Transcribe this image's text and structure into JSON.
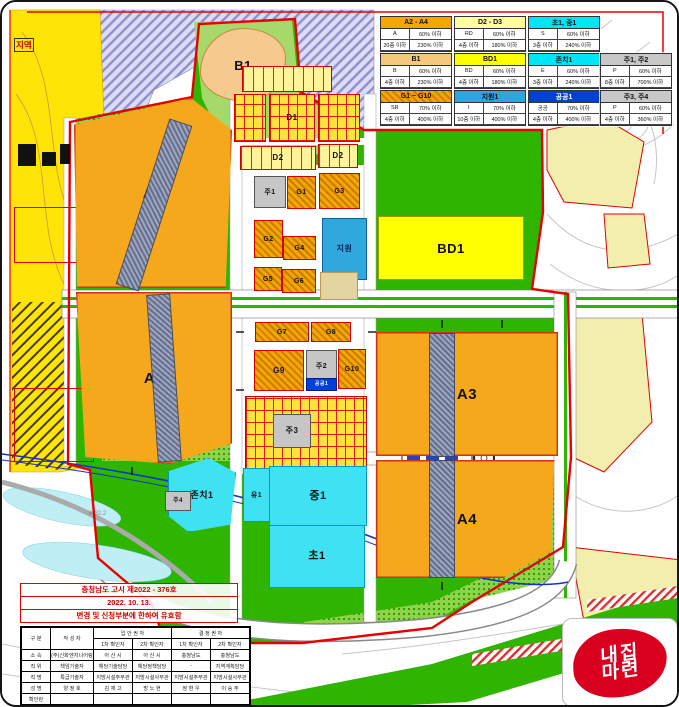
{
  "legend": {
    "items": [
      {
        "title": "A2 - A4",
        "color": "#F7A600",
        "hatched": false,
        "text_color": "#111",
        "cells": [
          [
            "A",
            "60% 이하"
          ],
          [
            "20층 이하",
            "230% 이하"
          ]
        ]
      },
      {
        "title": "D2 - D3",
        "color": "#FFFF9E",
        "hatched": false,
        "text_color": "#111",
        "cells": [
          [
            "RD",
            "60% 이하"
          ],
          [
            "4층 이하",
            "180% 이하"
          ]
        ]
      },
      {
        "title": "초1, 중1",
        "color": "#00E6F6",
        "hatched": false,
        "text_color": "#111",
        "cells": [
          [
            "S",
            "60% 이하"
          ],
          [
            "3층 이하",
            "240% 이하"
          ]
        ]
      },
      {
        "title": "B1",
        "color": "#F6C87E",
        "hatched": false,
        "text_color": "#111",
        "cells": [
          [
            "B",
            "60% 이하"
          ],
          [
            "4층 이하",
            "230% 이하"
          ]
        ]
      },
      {
        "title": "BD1",
        "color": "#FFFF00",
        "hatched": false,
        "text_color": "#111",
        "cells": [
          [
            "BD",
            "60% 이하"
          ],
          [
            "4층 이하",
            "180% 이하"
          ]
        ]
      },
      {
        "title": "존치1",
        "color": "#00E6F6",
        "hatched": false,
        "text_color": "#111",
        "cells": [
          [
            "E",
            "60% 이하"
          ],
          [
            "3층 이하",
            "240% 이하"
          ]
        ]
      },
      {
        "title": "주1, 주2",
        "color": "#C8C8C8",
        "hatched": false,
        "text_color": "#111",
        "cells": [
          [
            "P",
            "60% 이하"
          ],
          [
            "8층 이하",
            "700% 이하"
          ]
        ]
      },
      {
        "title": "G1 ~ G10",
        "color": "#F7A600",
        "hatched": true,
        "text_color": "#111",
        "cells": [
          [
            "SR",
            "70% 이하"
          ],
          [
            "4층 이하",
            "400% 이하"
          ]
        ]
      },
      {
        "title": "지원1",
        "color": "#2BA7DE",
        "hatched": false,
        "text_color": "#111",
        "cells": [
          [
            "I",
            "70% 이하"
          ],
          [
            "10층 이하",
            "400% 이하"
          ]
        ]
      },
      {
        "title": "공공1",
        "color": "#0040D8",
        "hatched": false,
        "text_color": "#ffffff",
        "cells": [
          [
            "공공",
            "70% 이하"
          ],
          [
            "4층 이하",
            "400% 이하"
          ]
        ]
      },
      {
        "title": "주3, 주4",
        "color": "#C8C8C8",
        "hatched": false,
        "text_color": "#111",
        "cells": [
          [
            "P",
            "60% 이하"
          ],
          [
            "4층 이하",
            "360% 이하"
          ]
        ]
      }
    ]
  },
  "map": {
    "block_labels": {
      "a1": "A1",
      "a2": "A2",
      "a3": "A3",
      "a4": "A4",
      "b1": "B1",
      "bd1": "BD1",
      "d1": "D1",
      "d2a": "D2",
      "d2b": "D2",
      "ju1": "주1",
      "g1": "G1",
      "g3": "G3",
      "g2": "G2",
      "g4": "G4",
      "jiwon": "지원",
      "g5": "G5",
      "g6": "G6",
      "g7": "G7",
      "g8": "G8",
      "g9": "G9",
      "ju2": "주2",
      "gong1": "공공1",
      "g10": "G10",
      "ju3": "주3",
      "jonchi1": "존치1",
      "ju4": "주4",
      "yu1": "유1",
      "jung1": "중1",
      "cho1": "초1"
    },
    "annotations": {
      "district": "지역",
      "elevation": "※ 32.2"
    }
  },
  "notice": {
    "lines": [
      "충청남도 고시 제2022 - 376호",
      "2022.  10.  13.",
      "변경 및 신청부분에 한하여 유효함"
    ]
  },
  "approval_table": {
    "corner": "구  분",
    "author": "작 성 자",
    "group1": "입 안 권 자",
    "group2": "결 정 권 자",
    "sub": [
      "1차 확인자",
      "2차 확인자",
      "1차 확인자",
      "2차 확인자"
    ],
    "rows": [
      {
        "label": "소  속",
        "cells": [
          "(주)신화엔지니어링",
          "아 산 시",
          "아 산 시",
          "충청남도",
          "충청남도"
        ]
      },
      {
        "label": "직  위",
        "cells": [
          "책임기술자",
          "해당기술담당",
          "해당정책담당",
          "-",
          "지역계획담당"
        ]
      },
      {
        "label": "직  명",
        "cells": [
          "특급기술자",
          "지방시설주무관",
          "지방시설사무관",
          "지방시설주무관",
          "지방시설사무관"
        ]
      },
      {
        "label": "성  명",
        "cells": [
          "양 정 호",
          "김 재 고",
          "방 노 현",
          "정 환 우",
          "이 승 주"
        ]
      },
      {
        "label": "확인란",
        "cells": [
          "",
          "",
          "",
          "",
          ""
        ]
      }
    ]
  },
  "logo": {
    "line1": "내집",
    "line2": "마련"
  }
}
